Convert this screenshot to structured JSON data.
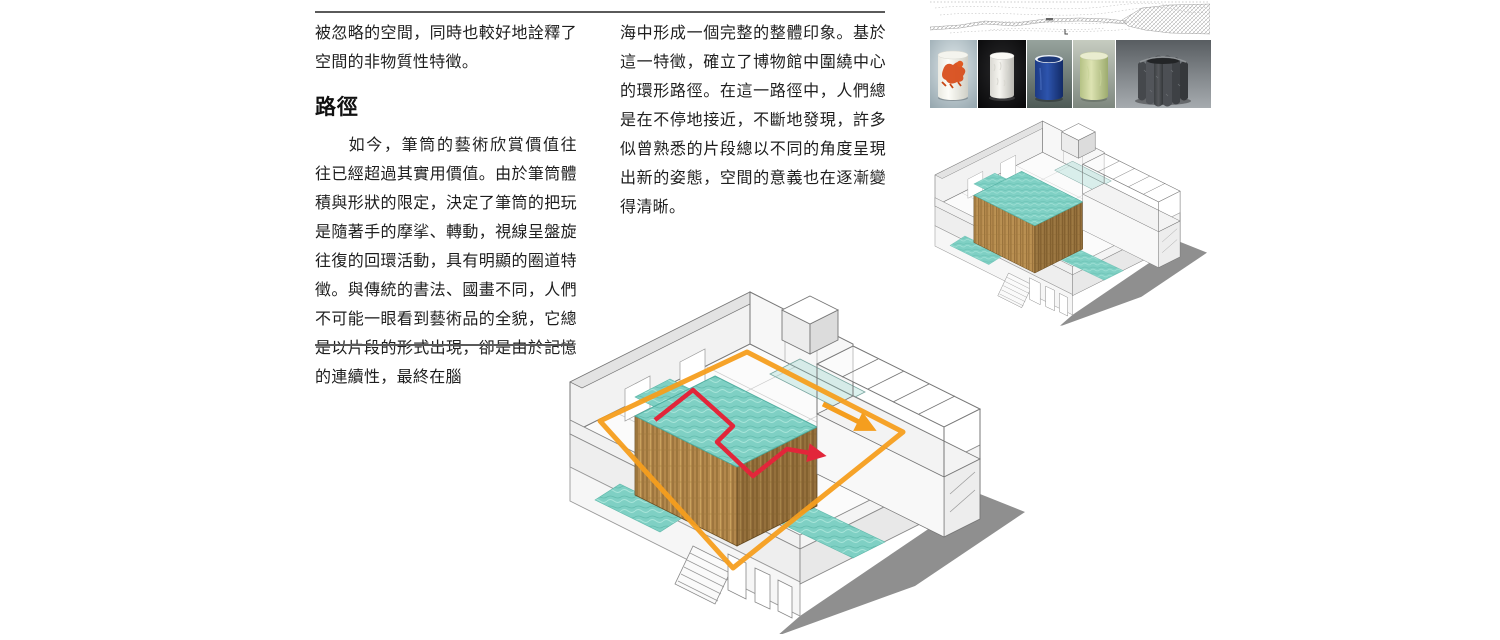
{
  "article": {
    "left_column": {
      "paragraph_continued": "被忽略的空間，同時也較好地詮釋了空間的非物質性特徵。",
      "heading": "路徑",
      "paragraph": "如今，筆筒的藝術欣賞價值往往已經超過其實用價值。由於筆筒體積與形狀的限定，決定了筆筒的把玩是隨著手的摩挲、轉動，視線呈盤旋往復的回環活動，具有明顯的圈道特徵。與傳統的書法、國畫不同，人們不可能一眼看到藝術品的全貌，它總是以片段的形式出現，卻是由於記憶的連續性，最終在腦"
    },
    "middle_column": {
      "paragraph_continued": "海中形成一個完整的整體印象。基於這一特徵，確立了博物館中圍繞中心的環形路徑。在這一路徑中，人們總是在不停地接近，不斷地發現，許多似曾熟悉的片段總以不同的角度呈現出新的姿態，空間的意義也在逐漸變得清晰。"
    }
  },
  "figures": {
    "site_plan": {
      "icon": "site-plan-map"
    },
    "brush_pots": {
      "photos": [
        {
          "icon": "brushpot-red-lion-porcelain"
        },
        {
          "icon": "brushpot-white-carved"
        },
        {
          "icon": "brushpot-blue-glaze"
        },
        {
          "icon": "brushpot-celadon-jade"
        },
        {
          "icon": "brushpot-gray-stone-lobed"
        }
      ]
    },
    "axonometric_small": {
      "icon": "museum-axonometric-cutaway"
    },
    "axonometric_large": {
      "icon": "museum-axonometric-cutaway-with-circulation"
    },
    "colors": {
      "path_orange": "#F59E1E",
      "path_red": "#E2263A",
      "water_teal": "#7FD0C4",
      "wood_tan": "#B3884C",
      "shadow_gray": "#8F8F8F",
      "rule_gray": "#5A5A5A"
    }
  }
}
